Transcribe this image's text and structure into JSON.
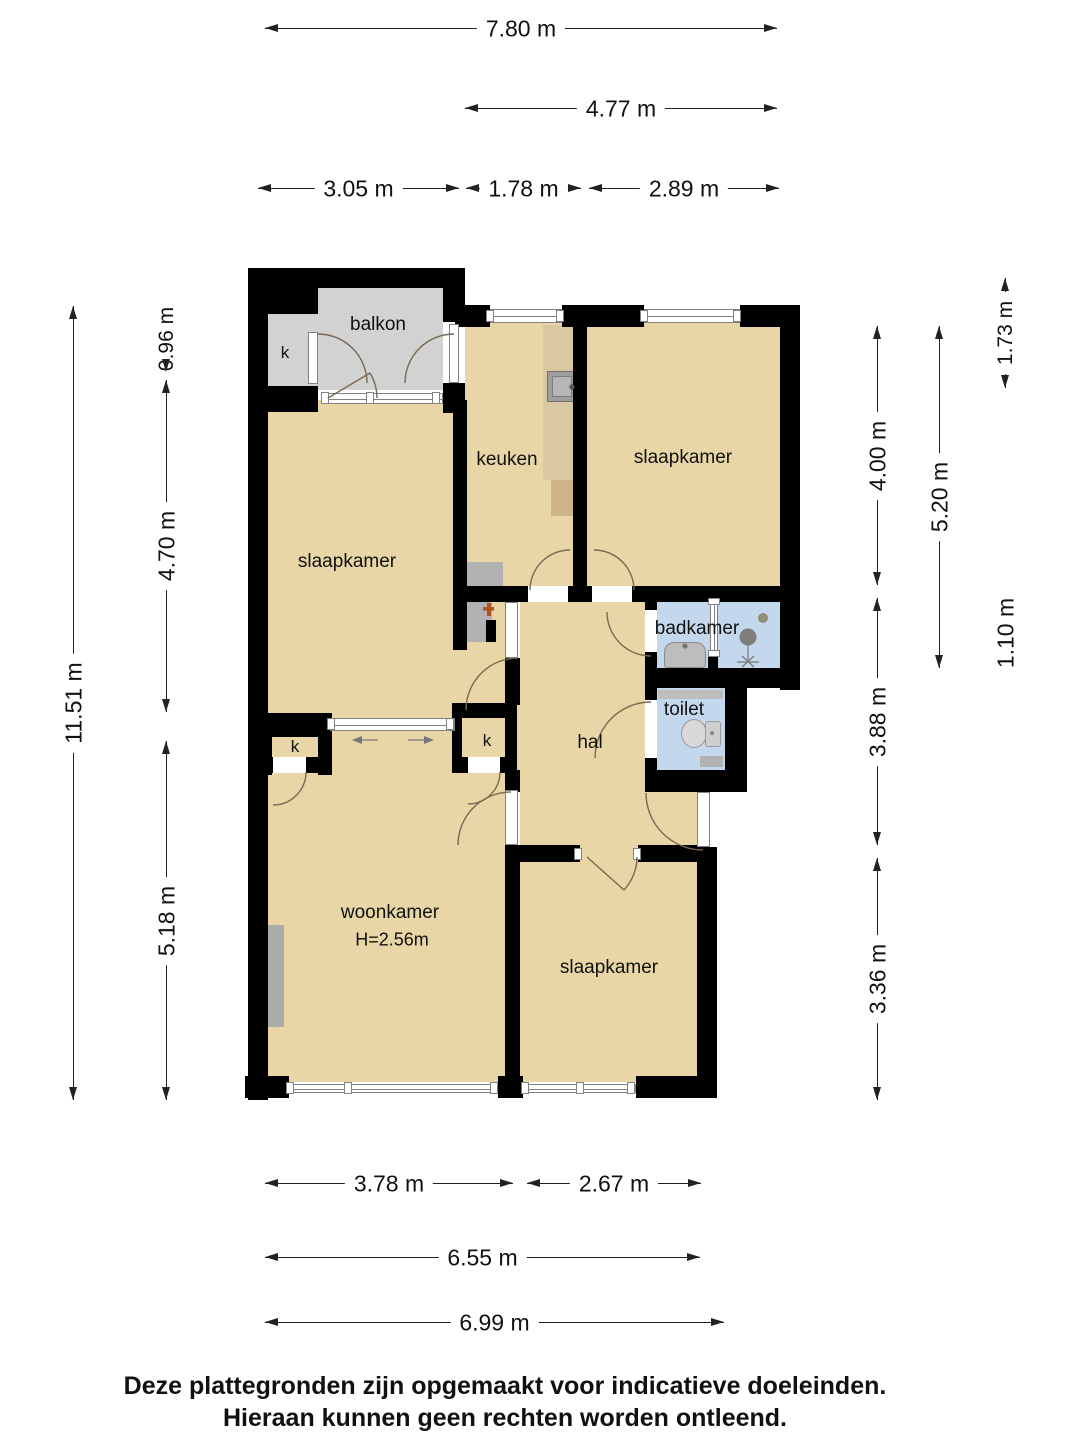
{
  "rooms": {
    "balkon": "balkon",
    "closet": "k",
    "keuken": "keuken",
    "slaapkamer": "slaapkamer",
    "badkamer": "badkamer",
    "toilet": "toilet",
    "hal": "hal",
    "woonkamer": "woonkamer",
    "woonkamer_ceiling_height": "H=2.56m"
  },
  "dimensions": {
    "top": {
      "w780": "7.80 m",
      "w477": "4.77 m",
      "w305": "3.05 m",
      "w178": "1.78 m",
      "w289": "2.89 m"
    },
    "left": {
      "h1151": "11.51 m",
      "h096": "0.96 m",
      "h470": "4.70 m",
      "h518": "5.18 m"
    },
    "right": {
      "h173": "1.73 m",
      "h400": "4.00 m",
      "h520": "5.20 m",
      "h110": "1.10 m",
      "h388": "3.88 m",
      "h336": "3.36 m"
    },
    "bottom": {
      "w378": "3.78 m",
      "w267": "2.67 m",
      "w655": "6.55 m",
      "w699": "6.99 m"
    }
  },
  "footer": {
    "line1": "Deze plattegronden zijn opgemaakt voor indicatieve doeleinden.",
    "line2": "Hieraan kunnen geen rechten worden ontleend."
  },
  "colors": {
    "wall": "#000000",
    "floor_tan": "#e9d6a6",
    "floor_gray": "#d2d2d2",
    "floor_blue": "#c3d8ec",
    "door_arc": "#7a6952",
    "window_frame": "#828282",
    "fixture_gray": "#b2b2b2",
    "counter_wood": "#dac8a2",
    "counter_wood_dark": "#cdb488"
  }
}
